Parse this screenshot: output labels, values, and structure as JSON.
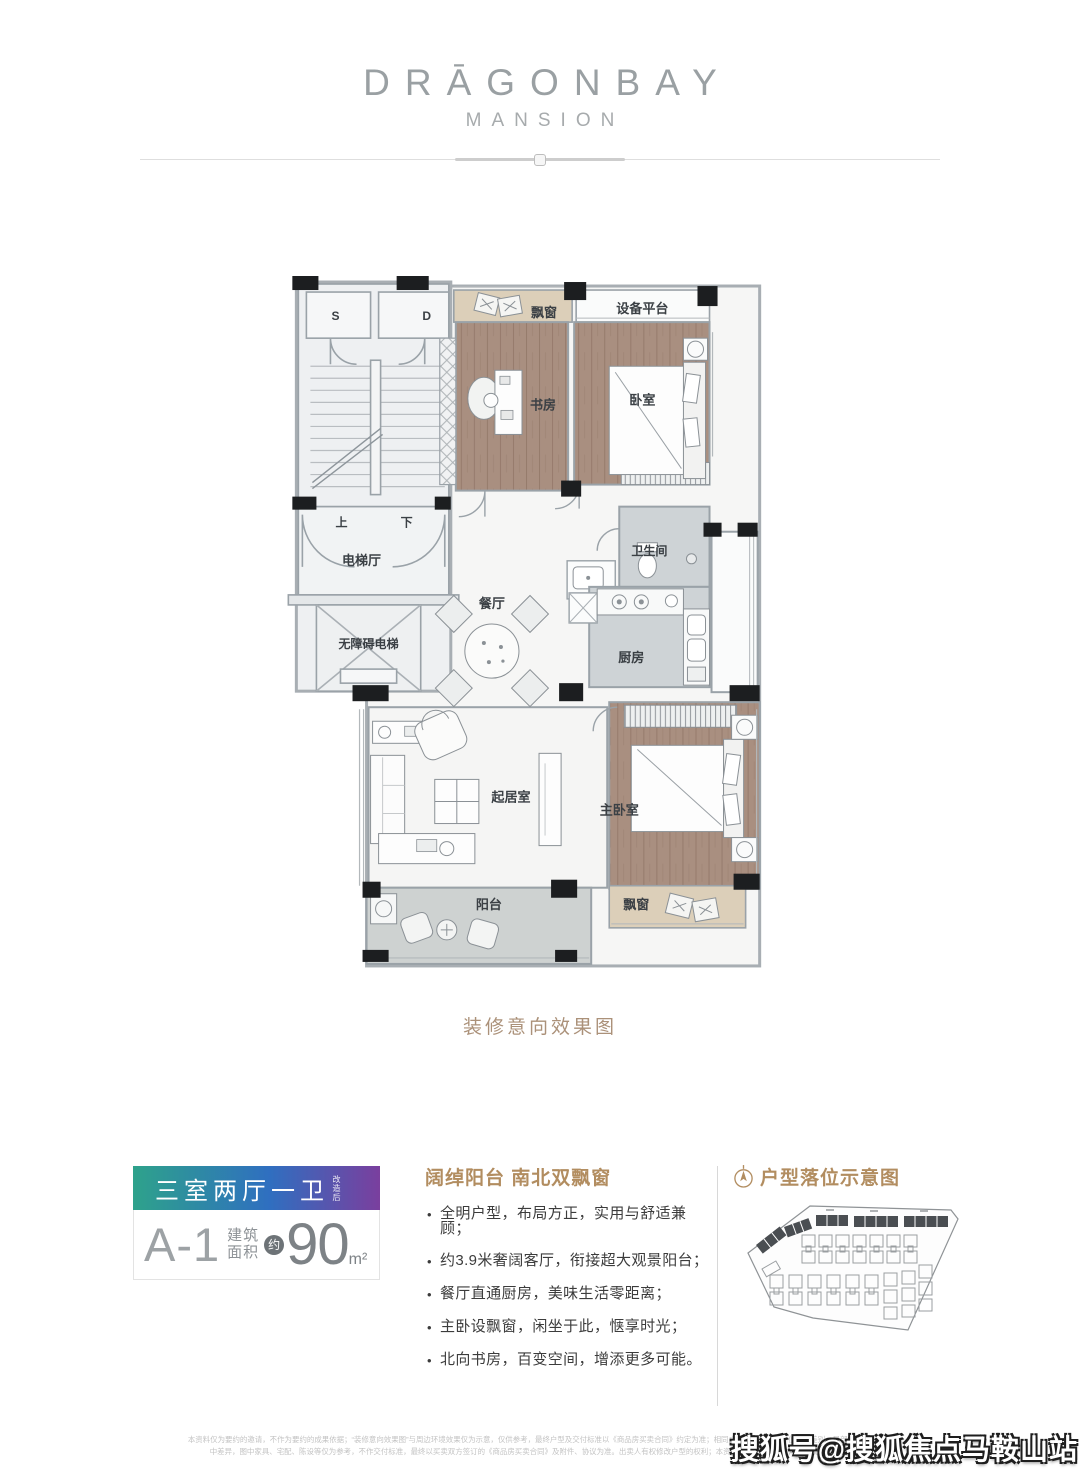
{
  "brand": {
    "title": "DRĀGONBAY",
    "subtitle": "MANSION"
  },
  "floorplan": {
    "caption": "装修意向效果图",
    "rooms": {
      "stair_s": "S",
      "stair_d": "D",
      "bay_window_top": "飘窗",
      "equipment_platform": "设备平台",
      "study": "书房",
      "bedroom": "卧室",
      "stair_up": "上",
      "stair_down": "下",
      "elevator_hall": "电梯厅",
      "accessible_elevator": "无障碍电梯",
      "dining_room": "餐厅",
      "bathroom": "卫生间",
      "kitchen": "厨房",
      "living_room": "起居室",
      "master_bedroom": "主卧室",
      "balcony": "阳台",
      "bay_window_bottom": "飘窗"
    }
  },
  "unit_card": {
    "layout_label": "三室两厅一卫",
    "layout_note": "改造后",
    "unit_code": "A-1",
    "area_label_line1": "建筑",
    "area_label_line2": "面积",
    "area_approx": "约",
    "area_value": "90",
    "area_unit": "m²",
    "gradient_colors": [
      "#2ea28b",
      "#2f6fc0",
      "#7a3f9e"
    ],
    "accent_gold": "#b28d60"
  },
  "highlights": {
    "heading": "阔绰阳台 南北双飘窗",
    "bullet": "•",
    "items": [
      "全明户型，布局方正，实用与舒适兼顾；",
      "约3.9米奢阔客厅，衔接超大观景阳台；",
      "餐厅直通厨房，美味生活零距离；",
      "主卧设飘窗，闲坐于此，惬享时光；",
      "北向书房，百变空间，增添更多可能。"
    ]
  },
  "location_map": {
    "heading": "户型落位示意图"
  },
  "watermark": "搜狐号@搜狐焦点马鞍山站",
  "disclaimer": {
    "line1": "本资料仅为要约的邀请，不作为要约的成果依据；“装修意向效果图”与周边环境效果仅为示意，仅供参考，最终户型及交付标准以《商品房买卖合同》约定为准；相同户型因所在楼层、位置等差别，局部结构面积或有",
    "line2": "中差异，图中家具、宅配、陈设等仅为参考，不作交付标准，最终以买卖双方签订的《商品房买卖合同》及附件、协议为准。出卖人有权修改户型的权利；本资料发布于2020年7月，敬请留意最新资料。"
  }
}
